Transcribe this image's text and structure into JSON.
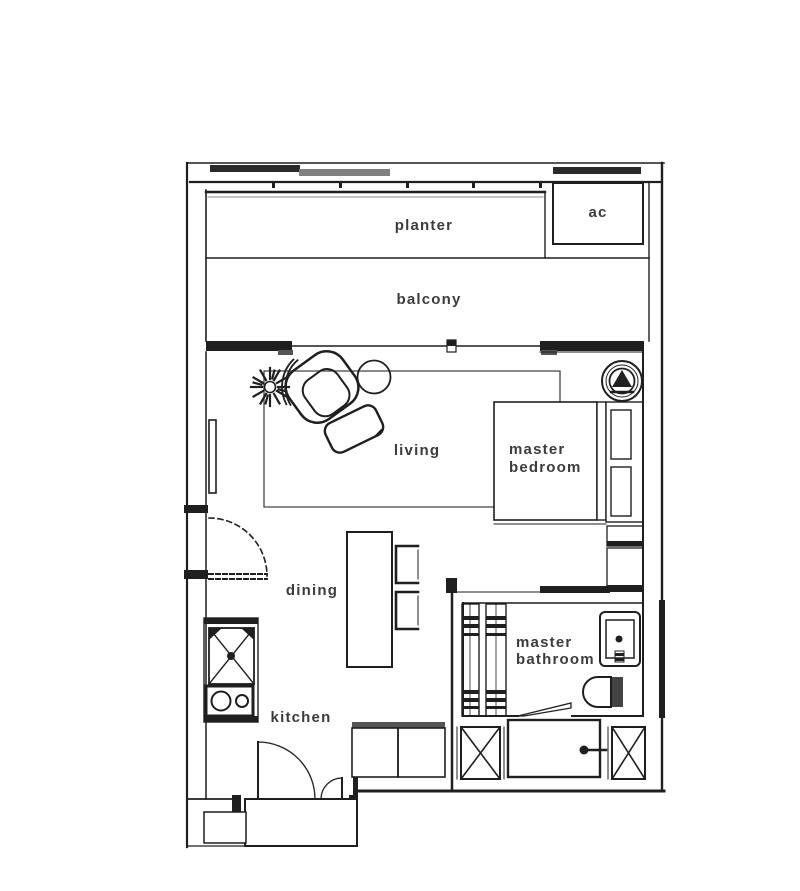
{
  "document": {
    "type": "apartment floor plan"
  },
  "rooms": {
    "planter": {
      "label": "planter"
    },
    "ac": {
      "label": "ac"
    },
    "balcony": {
      "label": "balcony"
    },
    "living": {
      "label": "living"
    },
    "master_bedroom": {
      "label": "master bedroom"
    },
    "dining": {
      "label": "dining"
    },
    "master_bathroom": {
      "label": "master bathroom"
    },
    "kitchen": {
      "label": "kitchen"
    }
  },
  "fixtures": [
    "plant-icon",
    "armchair-icon",
    "side-table-icon",
    "ottoman-icon",
    "tv-icon",
    "ceiling-fan-icon",
    "bed",
    "pillows",
    "wardrobe",
    "dining-table",
    "dining-chairs",
    "kitchen-sink-icon",
    "cooktop-icon",
    "entry-double-doors",
    "dashed-swing-door",
    "bathroom-door",
    "shower-screen",
    "wash-basin-icon",
    "toilet-icon",
    "bathtub-icon",
    "service-shaft-left",
    "service-shaft-right",
    "entry-bench",
    "vestibule"
  ],
  "colors": {
    "wall": "#1f1f1f",
    "gray_accent": "#808080",
    "dark_gray": "#555555",
    "label_text": "#3c3c3c",
    "background": "#ffffff"
  }
}
